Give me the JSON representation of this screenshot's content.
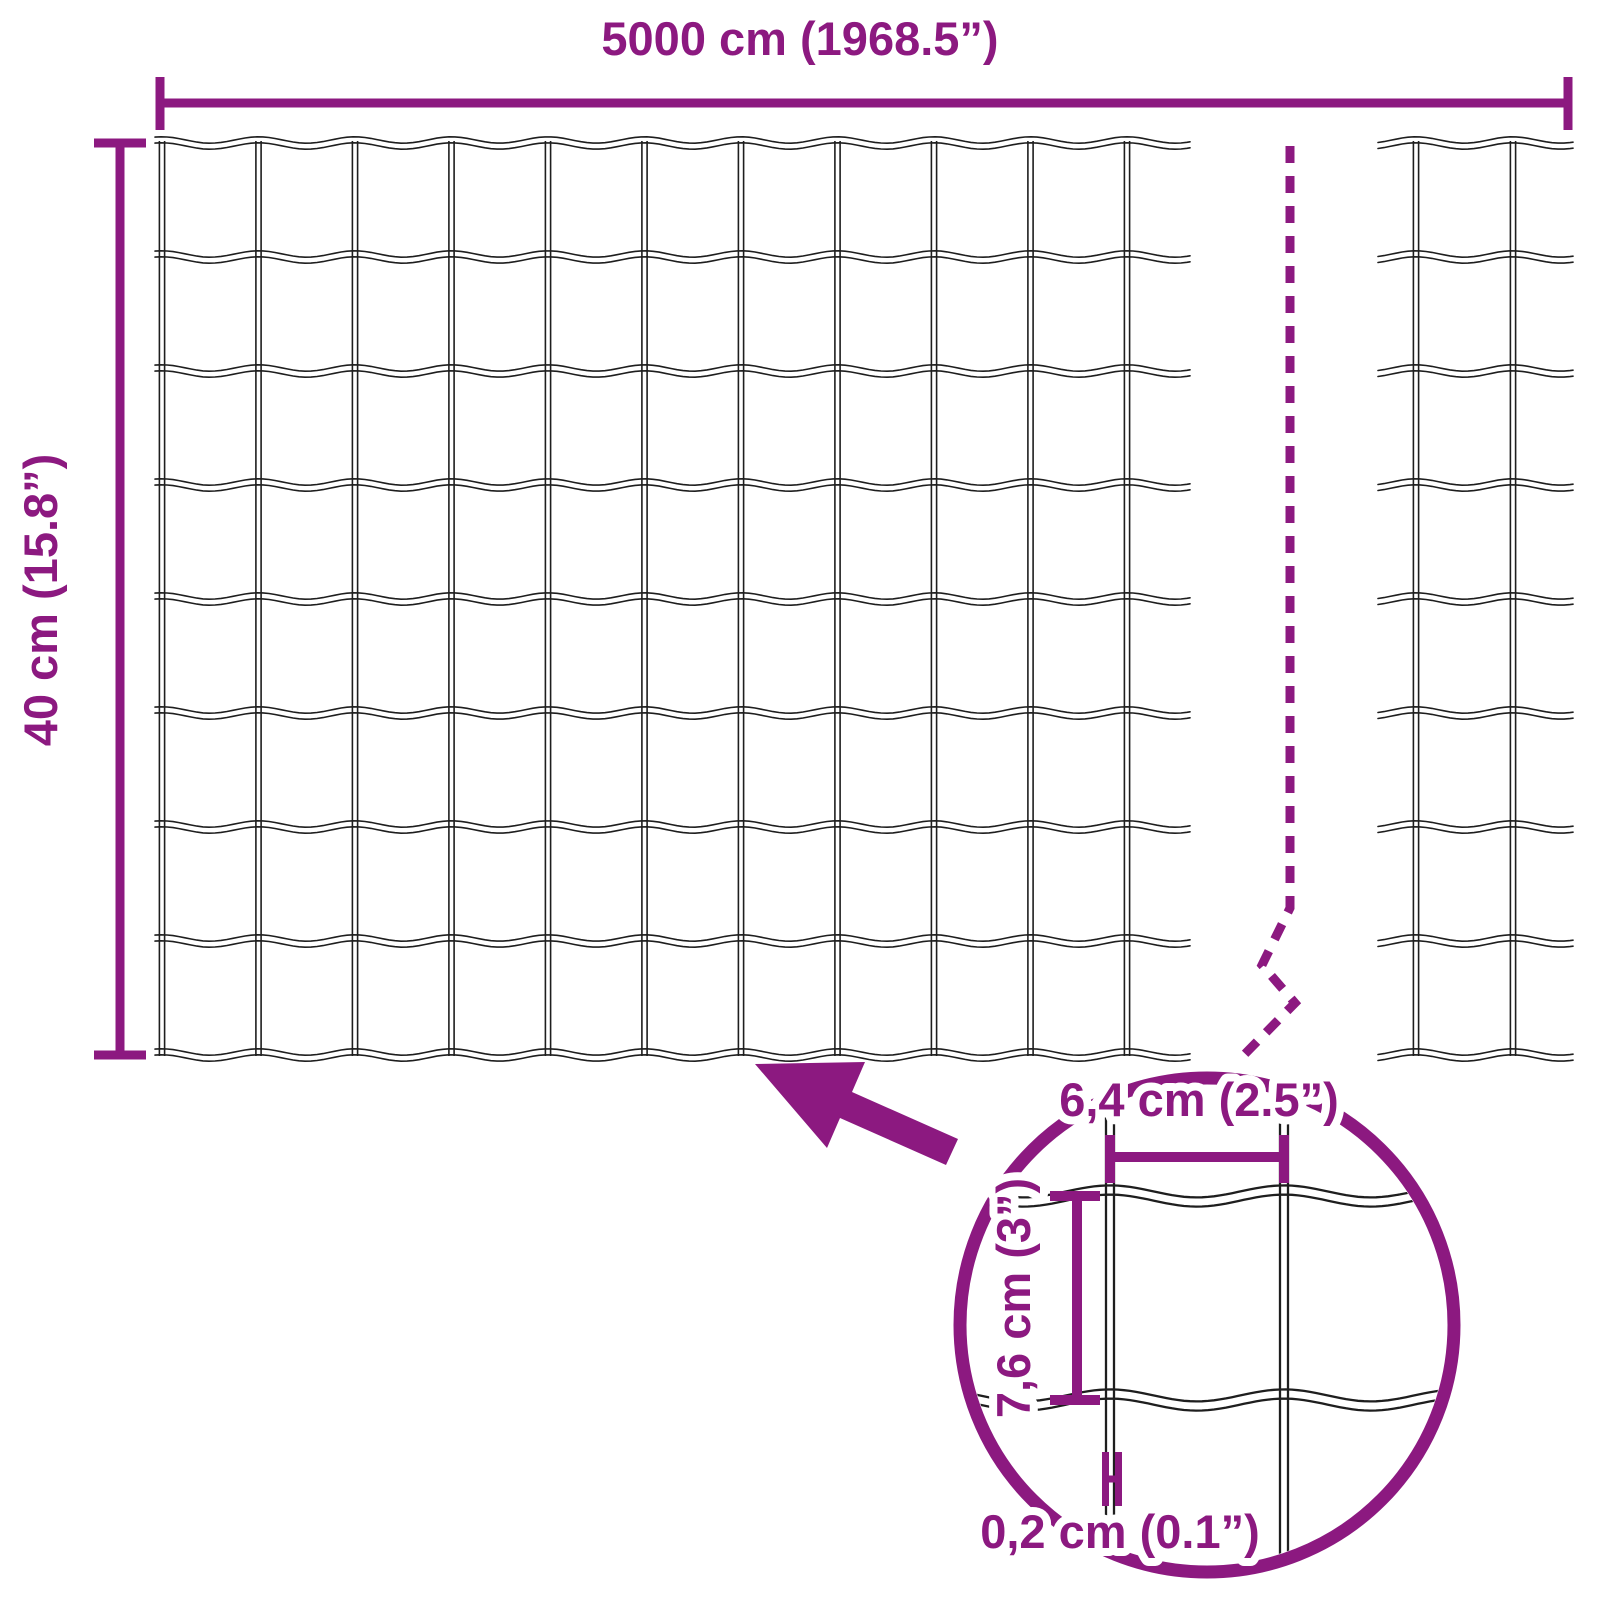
{
  "title": "Welded wire mesh fence roll dimensions diagram",
  "colors": {
    "accent": "#8C1980",
    "wire": "#1E1E1E",
    "background": "#FFFFFF"
  },
  "dimensions": {
    "width_label": "5000 cm (1968.5”)",
    "height_label": "40 cm (15.8”)"
  },
  "detail_view": {
    "mesh_width_label": "6,4 cm (2.5”)",
    "mesh_height_label": "7,6 cm (3”)",
    "wire_thickness_label": "0,2 cm (0.1”)"
  },
  "mesh": {
    "main_section_columns": 10,
    "main_section_rows": 8,
    "right_section_columns": 2,
    "wire_style": "double-line wavy horizontal wires, straight vertical wires"
  }
}
